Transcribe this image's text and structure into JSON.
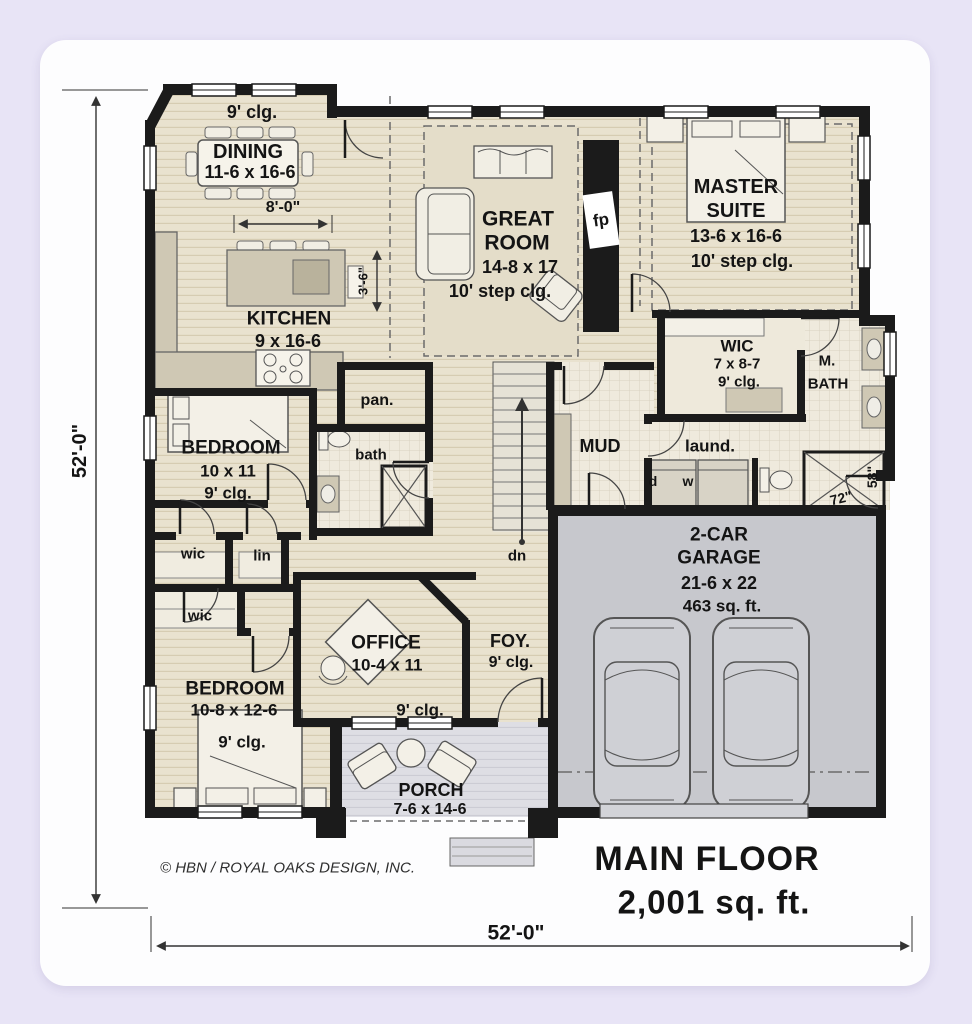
{
  "title": {
    "line1": "MAIN FLOOR",
    "line2": "2,001 sq. ft."
  },
  "copyright": "© HBN / ROYAL OAKS DESIGN, INC.",
  "dimensions": {
    "left": "52'-0\"",
    "bottom": "52'-0\"",
    "dining_width": "8'-0\"",
    "walkway": "3'-6\"",
    "shower_width": "72\"",
    "shower_depth": "58\""
  },
  "rooms": {
    "dining": {
      "ceiling": "9' clg.",
      "name": "DINING",
      "size": "11-6 x 16-6"
    },
    "great_room": {
      "name_line1": "GREAT",
      "name_line2": "ROOM",
      "size": "14-8 x 17",
      "ceiling": "10' step clg."
    },
    "master_suite": {
      "name_line1": "MASTER",
      "name_line2": "SUITE",
      "size": "13-6 x 16-6",
      "ceiling": "10' step clg."
    },
    "kitchen": {
      "name": "KITCHEN",
      "size": "9 x 16-6"
    },
    "master_wic": {
      "name": "WIC",
      "size": "7 x 8-7",
      "ceiling": "9' clg."
    },
    "master_bath": {
      "name_line1": "M.",
      "name_line2": "BATH"
    },
    "mud": {
      "name": "MUD"
    },
    "laundry": {
      "name": "laund.",
      "dryer": "d",
      "washer": "w"
    },
    "pantry": {
      "name": "pan."
    },
    "bath": {
      "name": "bath"
    },
    "bedroom1": {
      "name": "BEDROOM",
      "size": "10 x 11",
      "ceiling": "9' clg."
    },
    "wic1": {
      "name": "wic"
    },
    "linen": {
      "name": "lin"
    },
    "wic2": {
      "name": "wic"
    },
    "bedroom2": {
      "name": "BEDROOM",
      "size": "10-8 x 12-6",
      "ceiling": "9' clg."
    },
    "office": {
      "name": "OFFICE",
      "size": "10-4 x 11",
      "ceiling": "9' clg."
    },
    "foyer": {
      "name": "FOY.",
      "ceiling": "9' clg."
    },
    "porch": {
      "name": "PORCH",
      "size": "7-6 x 14-6"
    },
    "garage": {
      "name_line1": "2-CAR",
      "name_line2": "GARAGE",
      "size": "21-6 x 22",
      "area": "463 sq. ft."
    },
    "stairs": {
      "label": "dn"
    },
    "fireplace": {
      "label": "fp"
    }
  },
  "colors": {
    "background": "#e8e4f6",
    "card": "#fdfdfe",
    "wall": "#1b1b1b",
    "wood_floor": "#e9e2cf",
    "tile_floor": "#efeadd",
    "garage_floor": "#c7c8cd",
    "porch_floor": "#dedee4"
  }
}
